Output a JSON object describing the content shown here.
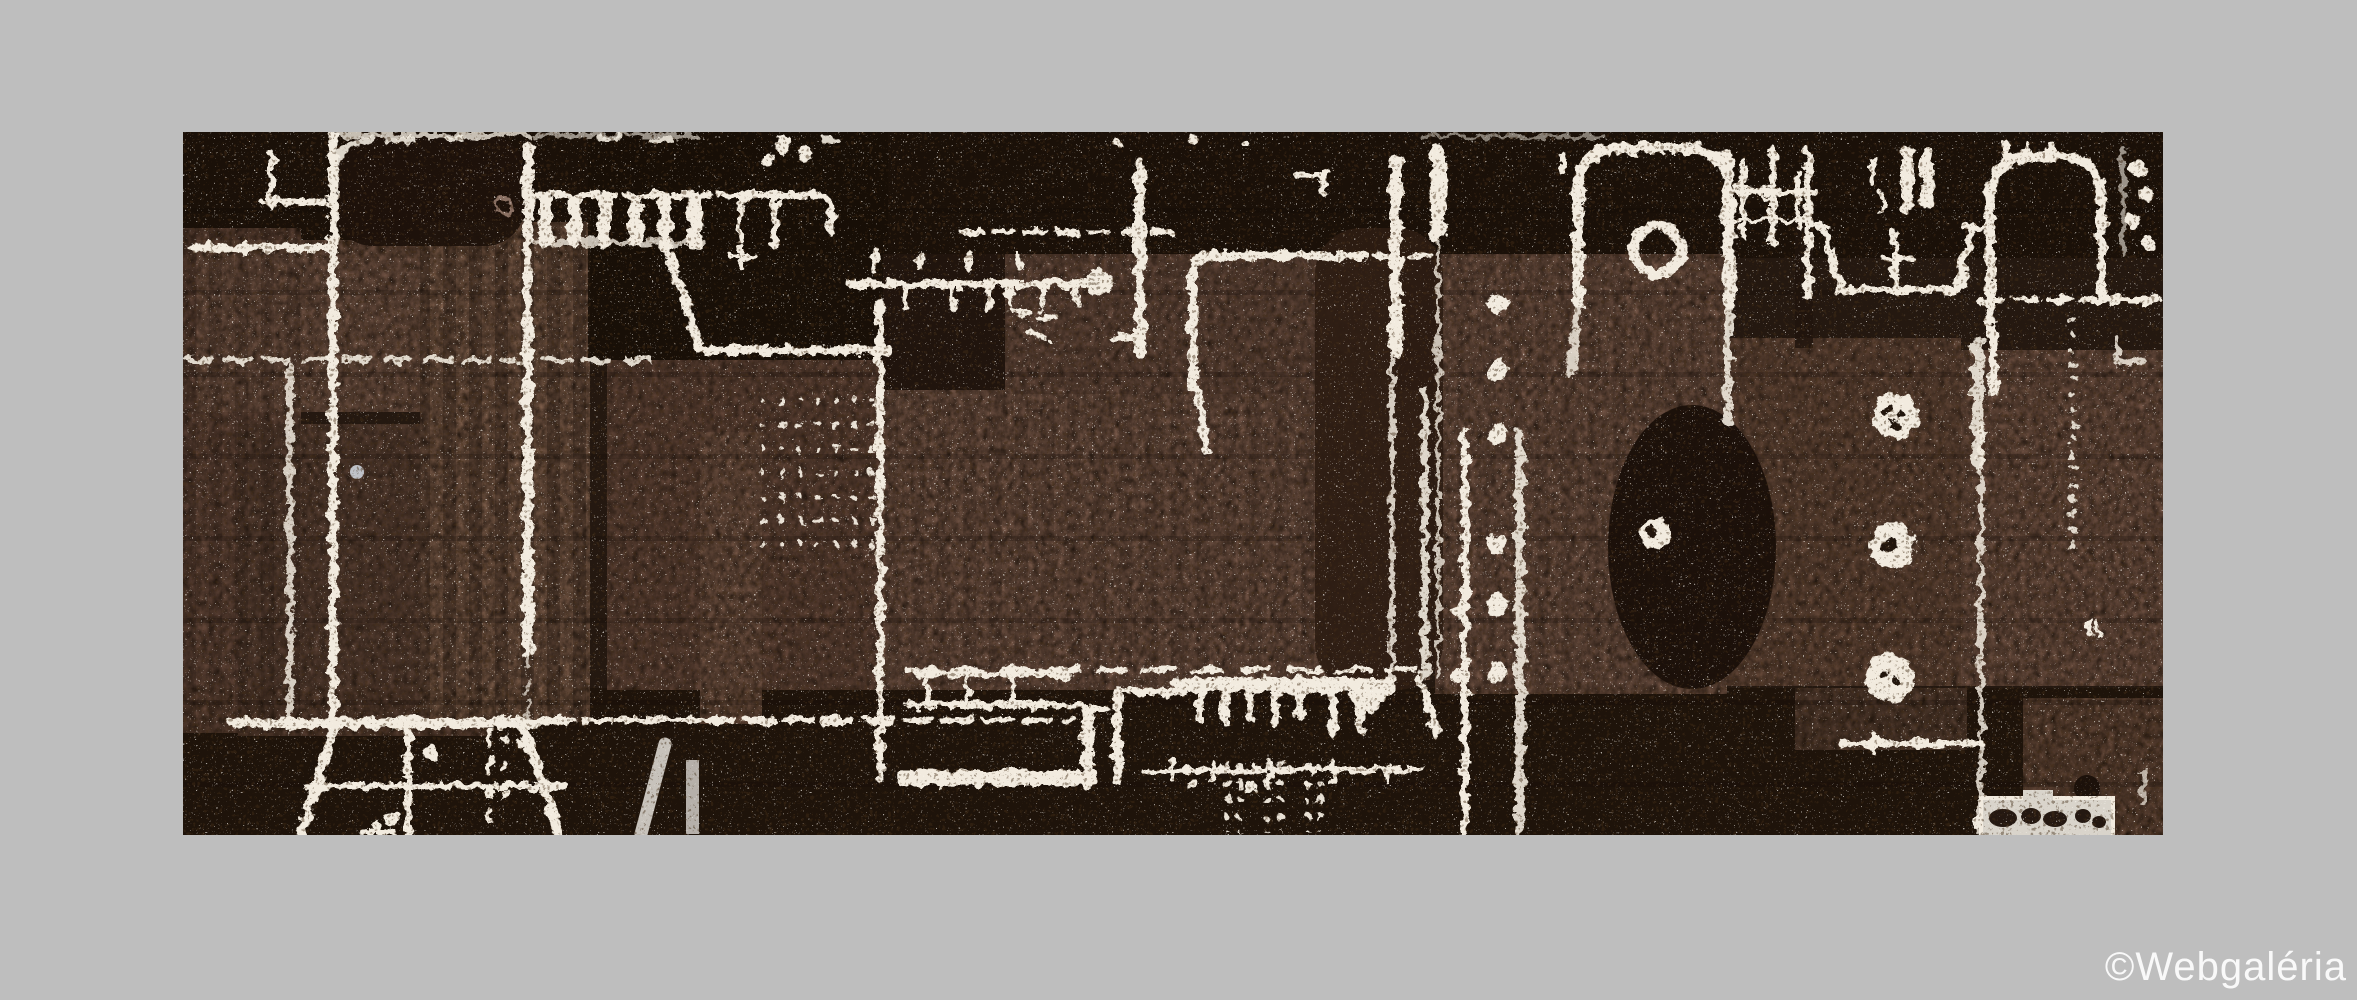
{
  "page": {
    "background": "#bebebe"
  },
  "artwork": {
    "description": "Abstract sepia-brown graphic print with white machinery-like line work, arches, dotted columns and comb shapes",
    "colors": {
      "base": "#241810",
      "shadow": "#190f08",
      "rose": "#84634f",
      "line": "#f2ebdf"
    }
  },
  "watermark": {
    "text": "©Webgaléria",
    "color": "#ffffff"
  }
}
